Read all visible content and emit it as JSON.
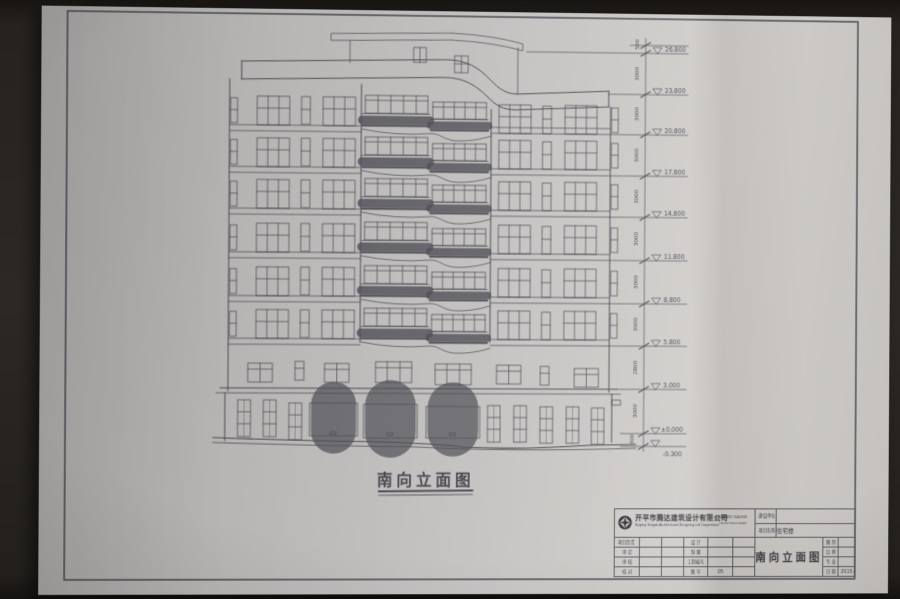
{
  "photo": {
    "scene": "architectural south-elevation blueprint sheet photographed on a dark table",
    "paper_color": "#c5c3c1",
    "line_color": "#4c4b53",
    "background_color": "#2c2824"
  },
  "drawing": {
    "title": "南向立面图",
    "elevation_levels": [
      {
        "label": "26.800"
      },
      {
        "label": "23.800"
      },
      {
        "label": "20.800"
      },
      {
        "label": "17.800"
      },
      {
        "label": "14.800"
      },
      {
        "label": "11.800"
      },
      {
        "label": "8.800"
      },
      {
        "label": "5.800"
      },
      {
        "label": "3.000"
      },
      {
        "label": "±0.000"
      },
      {
        "label": "-0.300"
      }
    ],
    "dimensions": [
      "500",
      "3000",
      "3000",
      "3000",
      "3000",
      "3000",
      "3000",
      "3000",
      "2800",
      "3000",
      "300"
    ]
  },
  "title_block": {
    "company_cn": "开平市腾达建筑设计有限公司",
    "company_en": "Kaiping Tengda Architectural Designing Ltd Corporation",
    "cert_line": "资质证书编号 C0440708",
    "tel_line": "TEL:(0750)2210463",
    "client_label": "建设单位",
    "client_value": "",
    "project_label": "项目名称",
    "project_value": "住宅楼",
    "left_rows": [
      "项目负责",
      "审 定",
      "审 核",
      "校 对"
    ],
    "mid_rows": [
      [
        "设 计",
        ""
      ],
      [
        "制 图",
        ""
      ],
      [
        "工程编号",
        ""
      ],
      [
        "图 号",
        "05"
      ]
    ],
    "drawing_name": "南向立面图",
    "right_rows": [
      [
        "图 别",
        ""
      ],
      [
        "比 例",
        ""
      ],
      [
        "专 业",
        ""
      ],
      [
        "日 期",
        "2015.05"
      ]
    ]
  }
}
